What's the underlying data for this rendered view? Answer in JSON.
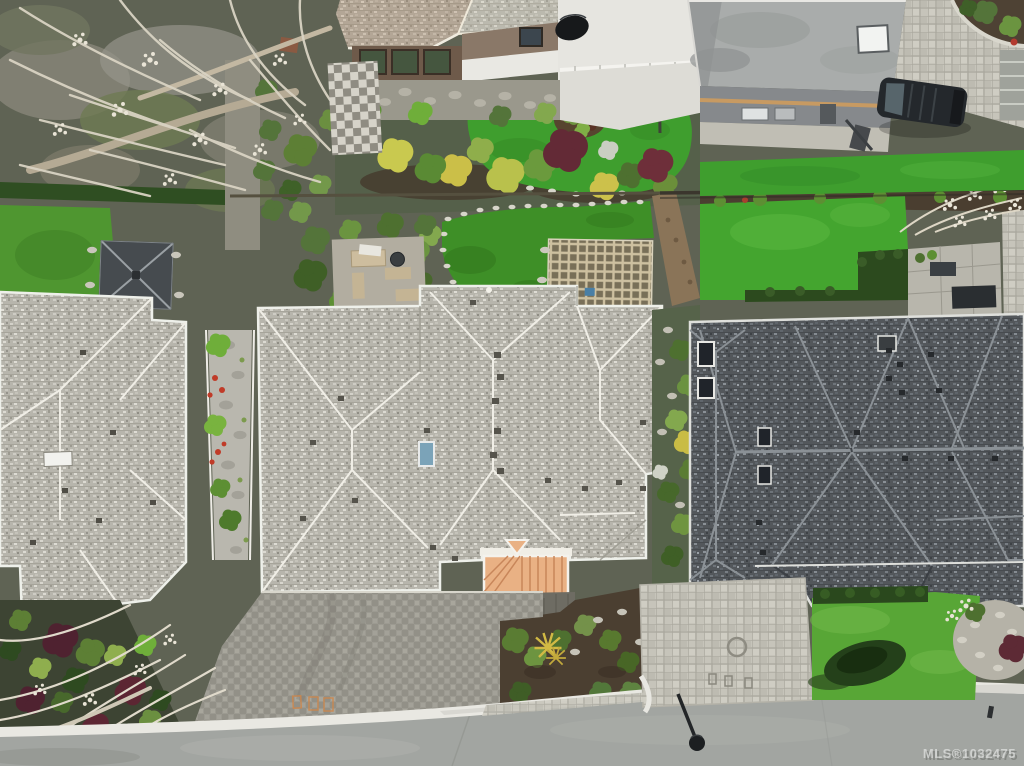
{
  "watermark": {
    "text": "MLS®1032475"
  },
  "palette": {
    "roof_light": "#b7b5ac",
    "roof_dark": "#53575b",
    "roof_tan": "#b5a894",
    "copper_roof": "#e9b184",
    "skylight_blue": "#7ba3b8",
    "turf_green": "#3f9e2e",
    "lawn_green": "#44a52f",
    "hedge_green": "#2c4a1e",
    "maroon_shrub": "#632a36",
    "yellow_shrub": "#c9c94f",
    "street_asphalt": "#a2a5a1",
    "paver_light": "#c6c4ba",
    "driveway_gray": "#9c9a91",
    "soil_brown": "#4a3c2e",
    "blossom_white": "#e9e4d6",
    "car_black": "#24282c"
  }
}
